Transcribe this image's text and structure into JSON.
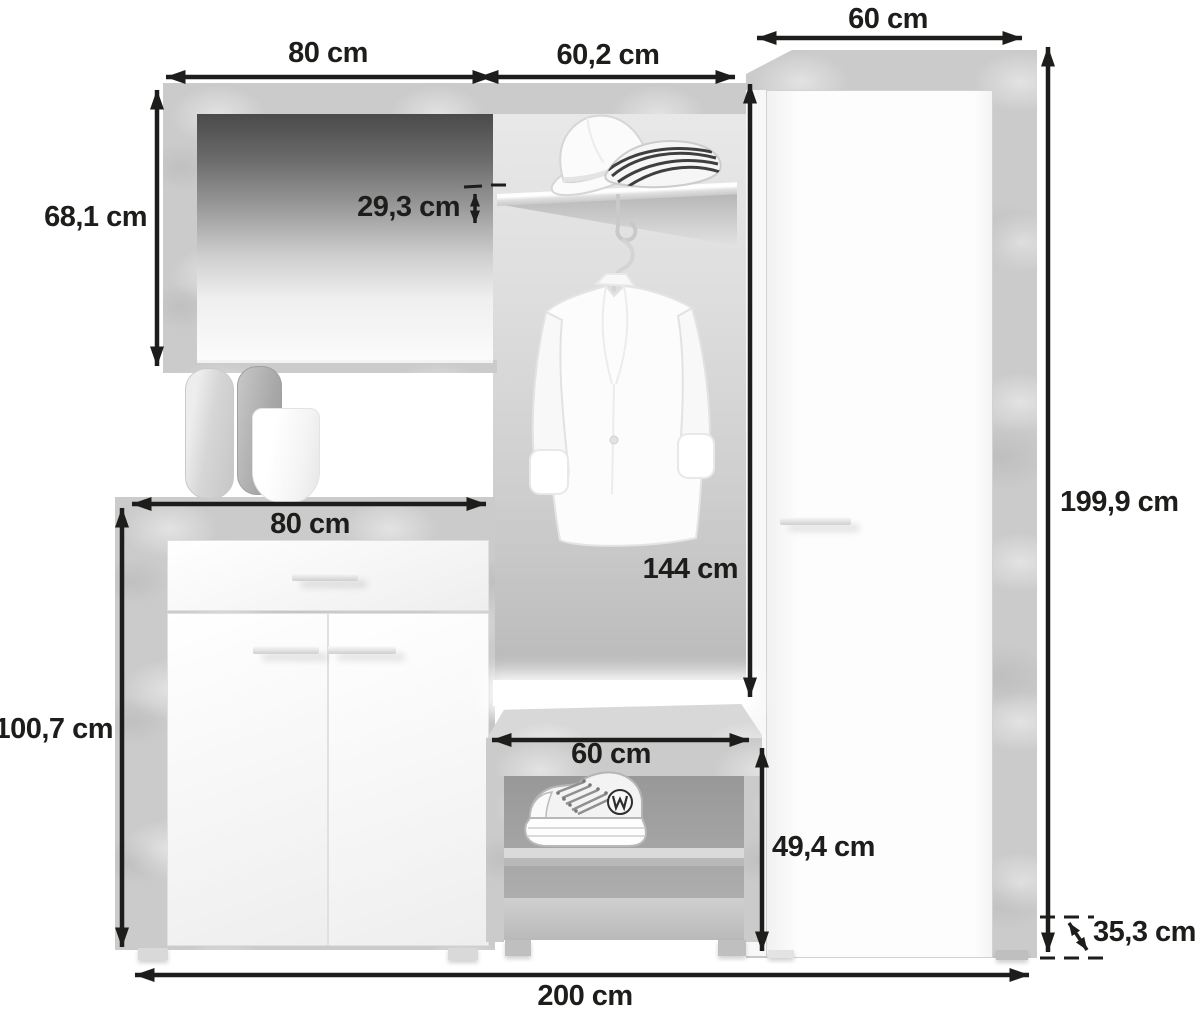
{
  "diagram": {
    "description": "Hallway furniture set (mirror, shoe cabinet, coat panel with shelf, bench, wardrobe) dimension diagram",
    "unit": "cm",
    "labels": {
      "mirror_width": "80 cm",
      "hook_panel_width": "60,2 cm",
      "wardrobe_width": "60 cm",
      "mirror_height": "68,1 cm",
      "shelf_to_top_offset": "29,3 cm",
      "cabinet_width": "80 cm",
      "hook_panel_height": "144 cm",
      "cabinet_height": "100,7 cm",
      "bench_width": "60 cm",
      "bench_height": "49,4 cm",
      "total_height": "199,9 cm",
      "total_depth": "35,3 cm",
      "total_width": "200 cm"
    },
    "colors": {
      "dimension_ink": "#1d1d1b",
      "concrete_gray": "#cbcbcb",
      "furniture_white": "#fdfdfd",
      "background": "#ffffff"
    }
  }
}
